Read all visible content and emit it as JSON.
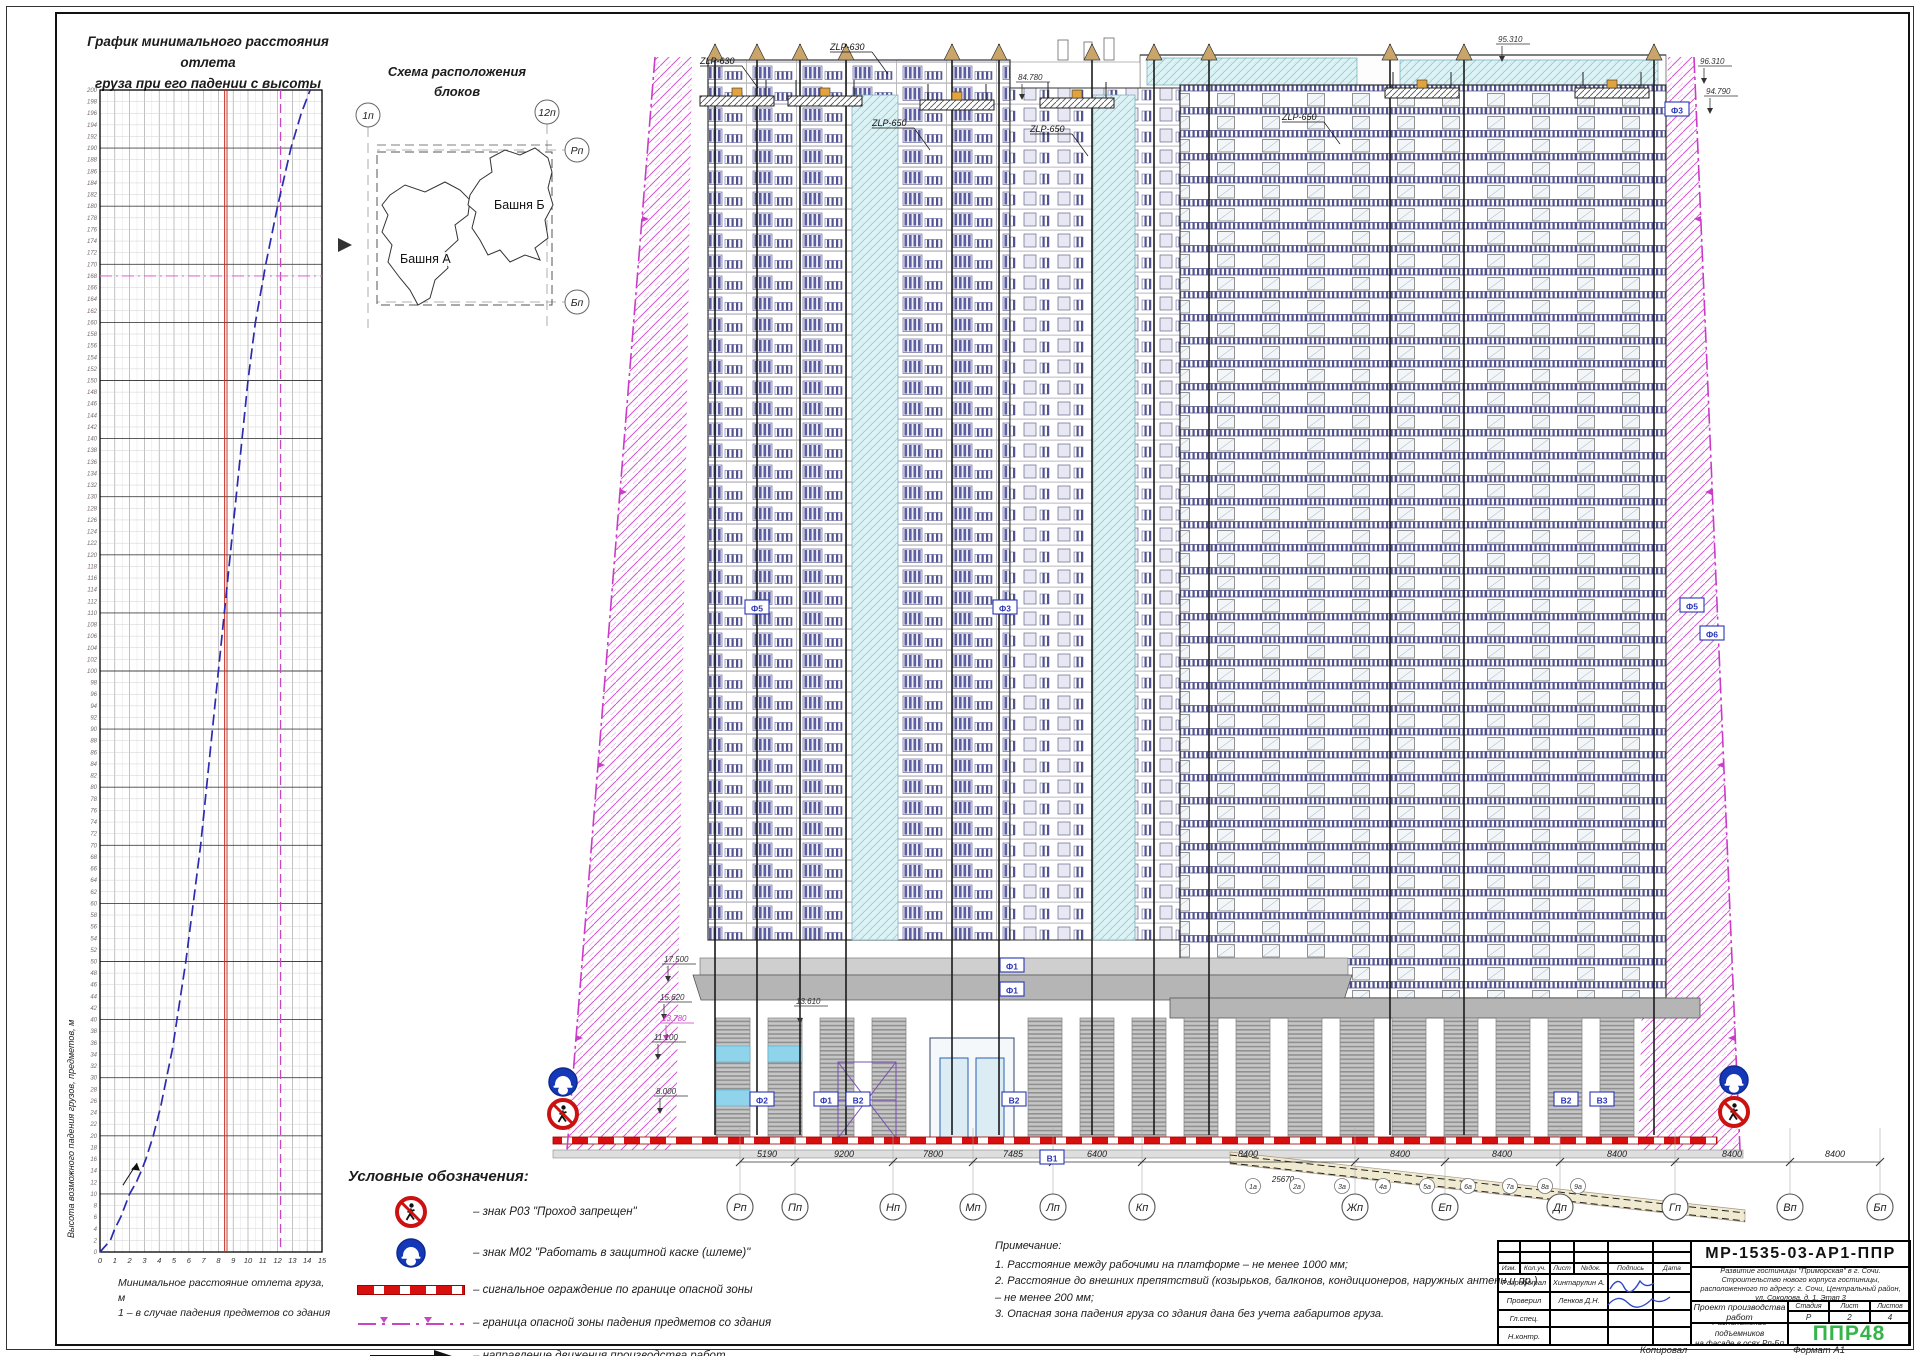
{
  "sheet": {
    "copied": "Копировал",
    "format": "Формат А1"
  },
  "chart_data": {
    "type": "line",
    "title_lines": [
      "График минимального расстояния отлета",
      "груза при его падении с высоты"
    ],
    "xlabel": "Минимальное расстояние отлета груза, м",
    "xnote": "1 – в случае падения предметов со здания",
    "ylabel": "Высота возможного падения грузов, предметов, м",
    "xlim": [
      0,
      15
    ],
    "ylim": [
      0,
      200
    ],
    "x_tick_step": 1,
    "y_tick_step": 2,
    "grid": true,
    "legend_position": "none",
    "series": [
      {
        "name": "1 – отлет груза при падении со здания",
        "color": "#2b2bb0",
        "style": "dashed",
        "points": [
          [
            0,
            0
          ],
          [
            0.7,
            2
          ],
          [
            1,
            4
          ],
          [
            1.4,
            6
          ],
          [
            1.7,
            8
          ],
          [
            2,
            10
          ],
          [
            2.45,
            12
          ],
          [
            2.8,
            14
          ],
          [
            3.1,
            16
          ],
          [
            3.35,
            18
          ],
          [
            3.6,
            20
          ],
          [
            4.1,
            25
          ],
          [
            4.5,
            30
          ],
          [
            4.9,
            35
          ],
          [
            5.2,
            40
          ],
          [
            5.8,
            50
          ],
          [
            6.3,
            60
          ],
          [
            6.8,
            70
          ],
          [
            7.2,
            80
          ],
          [
            7.6,
            90
          ],
          [
            8,
            100
          ],
          [
            8.4,
            110
          ],
          [
            8.8,
            120
          ],
          [
            9.2,
            130
          ],
          [
            9.6,
            140
          ],
          [
            10,
            150
          ],
          [
            10.5,
            160
          ],
          [
            11.2,
            170
          ],
          [
            12,
            180
          ],
          [
            12.9,
            190
          ],
          [
            13.6,
            196
          ],
          [
            14.2,
            200
          ]
        ]
      }
    ],
    "reference_lines": [
      {
        "axis": "x",
        "value": 8.5,
        "color": "#c2271f",
        "style": "solid-double"
      },
      {
        "axis": "x",
        "value": 12.2,
        "color": "#c646c6",
        "style": "dashed"
      },
      {
        "axis": "y",
        "value": 168,
        "color": "#e070d0",
        "style": "dash-dot"
      }
    ]
  },
  "scheme": {
    "title_lines": [
      "Схема расположения",
      "блоков"
    ],
    "tower_a": "Башня А",
    "tower_b": "Башня Б",
    "axis_1p": "1п",
    "axis_12p": "12п",
    "axis_rp": "Рп",
    "axis_bp": "Бп"
  },
  "elevation": {
    "axes": [
      {
        "label": "Рп",
        "x": 740
      },
      {
        "label": "Пп",
        "x": 795
      },
      {
        "label": "Нп",
        "x": 893
      },
      {
        "label": "Мп",
        "x": 973
      },
      {
        "label": "Лп",
        "x": 1053
      },
      {
        "label": "Кп",
        "x": 1142
      },
      {
        "label": "Жп",
        "x": 1355
      },
      {
        "label": "Еп",
        "x": 1445
      },
      {
        "label": "Дп",
        "x": 1560
      },
      {
        "label": "Гп",
        "x": 1675
      },
      {
        "label": "Вп",
        "x": 1790
      },
      {
        "label": "Бп",
        "x": 1880
      }
    ],
    "dims": [
      {
        "value": "5190",
        "x": 767
      },
      {
        "value": "9200",
        "x": 844
      },
      {
        "value": "7800",
        "x": 933
      },
      {
        "value": "7485",
        "x": 1013
      },
      {
        "value": "6400",
        "x": 1097
      },
      {
        "value": "8400",
        "x": 1248
      },
      {
        "value": "8400",
        "x": 1400
      },
      {
        "value": "8400",
        "x": 1502
      },
      {
        "value": "8400",
        "x": 1617
      },
      {
        "value": "8400",
        "x": 1732
      },
      {
        "value": "8400",
        "x": 1835
      }
    ],
    "dim_secondary": {
      "value": "25670",
      "x": 1283,
      "y": 1182
    },
    "sub_axes": [
      {
        "label": "1а",
        "x": 1253
      },
      {
        "label": "2а",
        "x": 1297
      },
      {
        "label": "3а",
        "x": 1342
      },
      {
        "label": "4а",
        "x": 1383
      },
      {
        "label": "5а",
        "x": 1427
      },
      {
        "label": "6а",
        "x": 1468
      },
      {
        "label": "7а",
        "x": 1510
      },
      {
        "label": "8а",
        "x": 1545
      },
      {
        "label": "9а",
        "x": 1578
      }
    ],
    "marks": [
      {
        "text": "95.310",
        "x": 1498,
        "y": 42
      },
      {
        "text": "96.310",
        "x": 1700,
        "y": 64
      },
      {
        "text": "94.790",
        "x": 1706,
        "y": 94
      },
      {
        "text": "84.780",
        "x": 1018,
        "y": 80
      },
      {
        "text": "17.500",
        "x": 664,
        "y": 962
      },
      {
        "text": "15.620",
        "x": 660,
        "y": 1000
      },
      {
        "text": "13.780",
        "x": 662,
        "y": 1021,
        "color": "#c83cc8"
      },
      {
        "text": "11.100",
        "x": 654,
        "y": 1040
      },
      {
        "text": "8.000",
        "x": 656,
        "y": 1094
      },
      {
        "text": "13.610",
        "x": 796,
        "y": 1004
      }
    ],
    "facade_labels": [
      {
        "text": "Ф5",
        "x": 757,
        "y": 608
      },
      {
        "text": "Ф3",
        "x": 1005,
        "y": 608
      },
      {
        "text": "Ф3",
        "x": 1677,
        "y": 110
      },
      {
        "text": "Ф5",
        "x": 1692,
        "y": 606
      },
      {
        "text": "Ф6",
        "x": 1712,
        "y": 634
      },
      {
        "text": "Ф1",
        "x": 1012,
        "y": 966
      },
      {
        "text": "Ф1",
        "x": 1012,
        "y": 990
      },
      {
        "text": "Ф2",
        "x": 762,
        "y": 1100
      },
      {
        "text": "Ф1",
        "x": 826,
        "y": 1100
      },
      {
        "text": "В2",
        "x": 858,
        "y": 1100
      },
      {
        "text": "В2",
        "x": 1014,
        "y": 1100
      },
      {
        "text": "В1",
        "x": 1052,
        "y": 1158
      },
      {
        "text": "В2",
        "x": 1566,
        "y": 1100
      },
      {
        "text": "В3",
        "x": 1602,
        "y": 1100
      }
    ],
    "platforms": [
      {
        "x": 700,
        "y": 96
      },
      {
        "x": 788,
        "y": 96
      },
      {
        "x": 920,
        "y": 100
      },
      {
        "x": 1040,
        "y": 98
      },
      {
        "x": 1385,
        "y": 88
      },
      {
        "x": 1575,
        "y": 88
      }
    ],
    "platform_labels": [
      {
        "text": "ZLP-630",
        "x": 700,
        "y": 64
      },
      {
        "text": "ZLP-630",
        "x": 830,
        "y": 50
      },
      {
        "text": "ZLP-650",
        "x": 872,
        "y": 126
      },
      {
        "text": "ZLP-650",
        "x": 1030,
        "y": 132
      },
      {
        "text": "ZLP-650",
        "x": 1282,
        "y": 120
      }
    ],
    "signs": [
      {
        "type": "m02",
        "x": 563,
        "y": 1082
      },
      {
        "type": "p03",
        "x": 563,
        "y": 1114
      },
      {
        "type": "m02",
        "x": 1734,
        "y": 1080
      },
      {
        "type": "p03",
        "x": 1734,
        "y": 1112
      }
    ]
  },
  "legend": {
    "heading": "Условные обозначения:",
    "items": [
      {
        "label": "– знак Р03 \"Проход запрещен\""
      },
      {
        "label": "– знак М02 \"Работать в защитной каске (шлеме)\""
      },
      {
        "label": "– сигнальное ограждение по границе опасной зоны"
      },
      {
        "label": "– граница опасной зоны падения предметов со здания"
      },
      {
        "label": "– направление движения производства работ"
      }
    ]
  },
  "notes": {
    "heading": "Примечание:",
    "items": [
      "1.  Расстояние между рабочими на платформе – не менее 1000 мм;",
      "2.  Расстояние до внешних  препятствий (козырьков, балконов, кондиционеров, наружных антенн и пр.) – не менее 200 мм;",
      "3.  Опасная зона падения груза со здания дана без учета габаритов груза."
    ]
  },
  "titleblock": {
    "code": "МР-1535-03-АР1-ППР",
    "project": "Развитие гостиницы \"Приморская\" в г. Сочи. Строительство нового корпуса гостиницы, расположенного по адресу: г. Сочи, Центральный район, ул. Соколова, д. 1. Этап 3",
    "doc_title": "Проект производства работ",
    "sheet_title_lines": [
      "Расположение подъемников",
      "на фасаде в осях Рп-Бп"
    ],
    "stage_label": "Стадия",
    "sheet_label": "Лист",
    "sheets_label": "Листов",
    "stage": "Р",
    "sheet": "2",
    "sheets": "4",
    "logo": "ППР48",
    "logo_color": "#35b44a",
    "header_cols": [
      "Изм.",
      "Кол.уч.",
      "Лист",
      "№док.",
      "Подпись",
      "Дата"
    ],
    "roles": [
      {
        "role": "Разработал",
        "name": "Хинтарулин А."
      },
      {
        "role": "Проверил",
        "name": "Ленков Д.Н."
      },
      {
        "role": "Гл.спец.",
        "name": ""
      },
      {
        "role": "Н.контр.",
        "name": ""
      }
    ]
  }
}
